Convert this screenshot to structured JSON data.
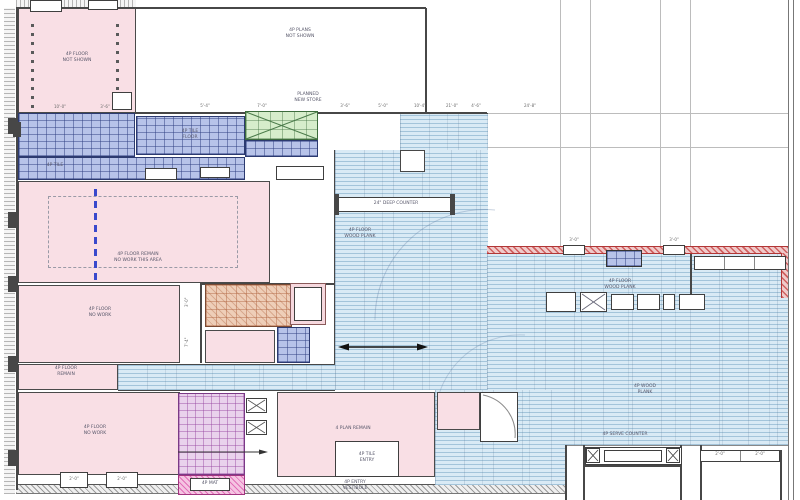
{
  "drawing": {
    "type": "architectural floor plan",
    "flooring_legend": {
      "pink": "existing rooms to remain",
      "blue_tile": "tile flooring",
      "blue_plank": "wood plank flooring",
      "green": "skylight / shaft",
      "tan": "restroom tile",
      "purple": "restroom tile",
      "red": "rated demising wall"
    }
  },
  "colors": {
    "pink": "#f9dfe5",
    "tile_blue": "#b7c3e9",
    "tile_blue_line": "#2c3a70",
    "plank_blue": "#d9eaf5",
    "green": "#d6edcb",
    "tan": "#eeceb8",
    "purple": "#e9d2ec",
    "magenta": "#f5c4e2",
    "red_wall": "#b23636",
    "wall": "#474747",
    "dashed_divider": "#3a49cc"
  },
  "labels": {
    "note_top": "4P PLANS\nNOT SHOWN",
    "planned": "PLANNED\nNEW STORE",
    "pink_topleft": "4P FLOOR\nNOT SHOWN",
    "big_pink": "4P FLOOR REMAIN\nNO WORK THIS AREA",
    "room_c": "4P FLOOR\nNO WORK",
    "small_left": "4P FLOOR\nREMAIN",
    "bottom_left": "4P FLOOR\nNO WORK",
    "tile_main": "4P TILE\nFLOOR",
    "tile_strip": "4P TILE",
    "plank_a": "4P FLOOR\nWOOD PLANK",
    "plank_b": "4P FLOOR\nWOOD PLANK",
    "plank_c": "4P WOOD\nPLANK",
    "counter_deep": "24\" DEEP COUNTER",
    "bottom_center_room": "4 PLAN REMAIN",
    "bottom_inset": "4P TILE\nENTRY",
    "vestibule_note": "4P ENTRY\nVESTIBULE",
    "serve_counter": "4P SERVE COUNTER",
    "mat_box": "4P MAT",
    "box_left": "2'-0\"",
    "box_right": "2'-0\""
  },
  "dims": {
    "d1": "10'-0\"",
    "d2": "3'-6\"",
    "d3": "5'-4\"",
    "d4": "7'-0\"",
    "d5": "3'-6\"",
    "d6": "5'-0\"",
    "d7": "10'-4\"",
    "d8": "21'-0\"",
    "d9": "4'-6\"",
    "d10": "24'-8\"",
    "door_left": "3'-0\"",
    "door_right": "3'-0\"",
    "c2a": "2'-0\"",
    "c2b": "2'-0\"",
    "v1": "3'-0\"",
    "v2": "7'-4\""
  }
}
